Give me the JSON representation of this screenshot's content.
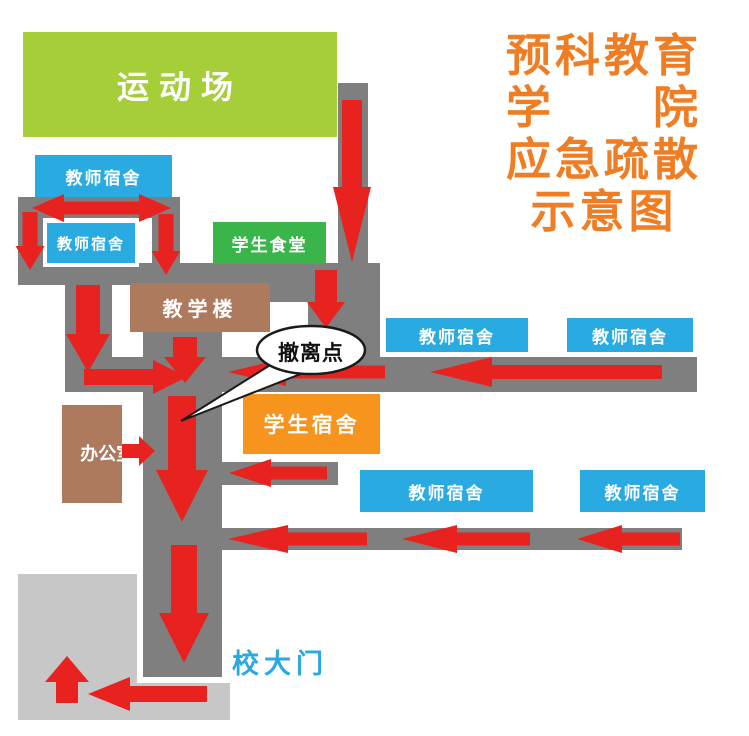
{
  "title": {
    "lines": [
      "预科教育",
      "学　　院",
      "应急疏散",
      "示意图"
    ],
    "color": "#ee7d23"
  },
  "buildings": [
    {
      "key": "sports-field",
      "label": "运动场",
      "color": "#a5ce39"
    },
    {
      "key": "teacher-dorm-1",
      "label": "教师宿舍",
      "color": "#29abe2"
    },
    {
      "key": "teacher-dorm-2",
      "label": "教师宿舍",
      "color": "#29abe2"
    },
    {
      "key": "student-canteen",
      "label": "学生食堂",
      "color": "#39b54a"
    },
    {
      "key": "teaching-building",
      "label": "教学楼",
      "color": "#ae7a5e"
    },
    {
      "key": "teacher-dorm-3",
      "label": "教师宿舍",
      "color": "#29abe2"
    },
    {
      "key": "teacher-dorm-4",
      "label": "教师宿舍",
      "color": "#29abe2"
    },
    {
      "key": "student-dorm",
      "label": "学生宿舍",
      "color": "#f7941e"
    },
    {
      "key": "office",
      "label": "办公室",
      "color": "#ae7a5e"
    },
    {
      "key": "teacher-dorm-5",
      "label": "教师宿舍",
      "color": "#29abe2"
    },
    {
      "key": "teacher-dorm-6",
      "label": "教师宿舍",
      "color": "#29abe2"
    }
  ],
  "annotations": {
    "evacuation_point": "撤离点",
    "school_gate": "校大门"
  },
  "colors": {
    "road": "#7f7f7f",
    "open_area": "#c7c7c7",
    "arrow": "#e8231f",
    "gate_text": "#29a9e0",
    "bubble_fill": "#ffffff",
    "bubble_stroke": "#1a1a1a"
  }
}
